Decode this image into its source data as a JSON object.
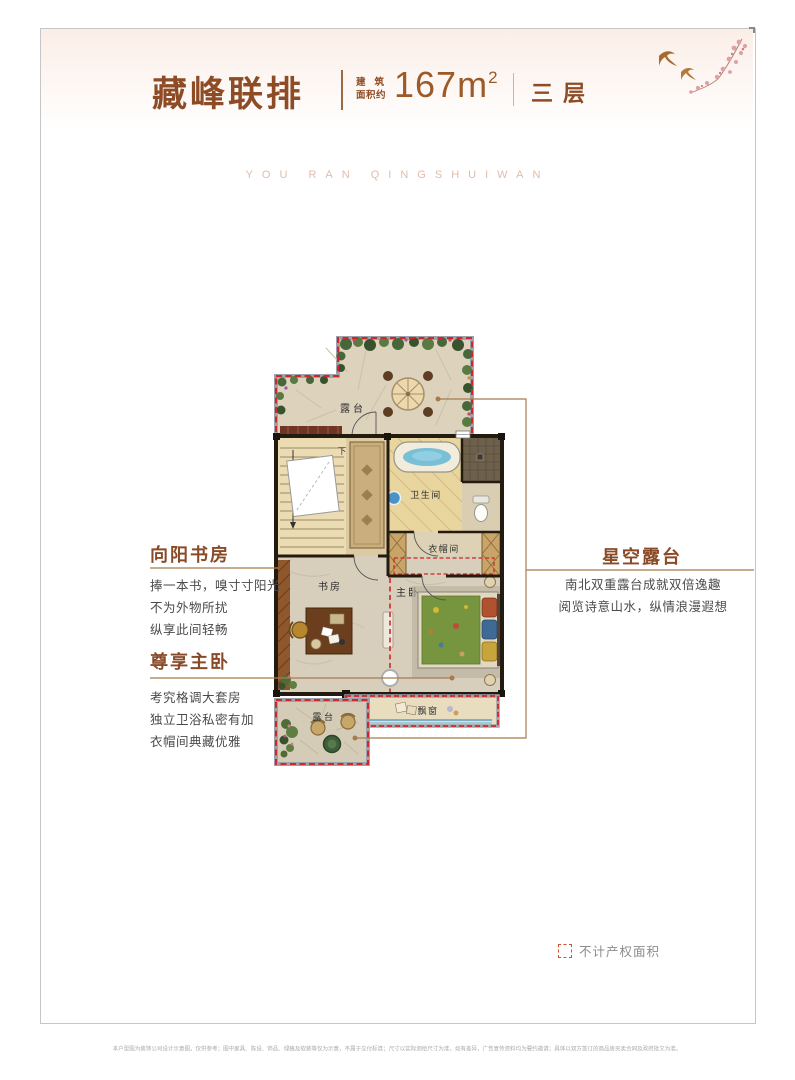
{
  "page": {
    "watermark": "YOU RAN QINGSHUIWAN"
  },
  "header": {
    "title": "藏峰联排",
    "area_label_line1": "建筑",
    "area_label_line2": "面积约",
    "area_value": "167m",
    "area_sup": "2",
    "floor": "三层"
  },
  "annotations": {
    "study": {
      "title": "向阳书房",
      "lines": [
        "捧一本书，嗅寸寸阳光",
        "不为外物所扰",
        "纵享此间轻畅"
      ]
    },
    "master": {
      "title": "尊享主卧",
      "lines": [
        "考究格调大套房",
        "独立卫浴私密有加",
        "衣帽间典藏优雅"
      ]
    },
    "terrace": {
      "title": "星空露台",
      "lines": [
        "南北双重露台成就双倍逸趣",
        "阅览诗意山水，纵情浪漫遐想"
      ]
    }
  },
  "floorplan": {
    "labels": {
      "terrace_top": "露台",
      "bathroom": "卫生间",
      "closet": "衣帽间",
      "study": "书房",
      "master_bedroom": "主卧",
      "bay_window": "飘窗",
      "terrace_bottom": "露台",
      "stairs_down": "下"
    }
  },
  "legend": {
    "label": "不计产权面积"
  },
  "disclaimer": {
    "text": "本户型图为装饰公司设计示意图，仅供参考；图中家具、陈设、饰品、绿植及软装等仅为示意，不属于交付标准；尺寸以实际测绘尺寸为准，如有差异，广告宣传资料均为要约邀请；具体以双方签订的商品房买卖合同及政府批文为准。"
  },
  "colors": {
    "accent_brown": "#8e4c26",
    "leader_line": "#a87b4e",
    "dash_red": "#cf2828",
    "watermark_pink": "#e2bcab"
  }
}
